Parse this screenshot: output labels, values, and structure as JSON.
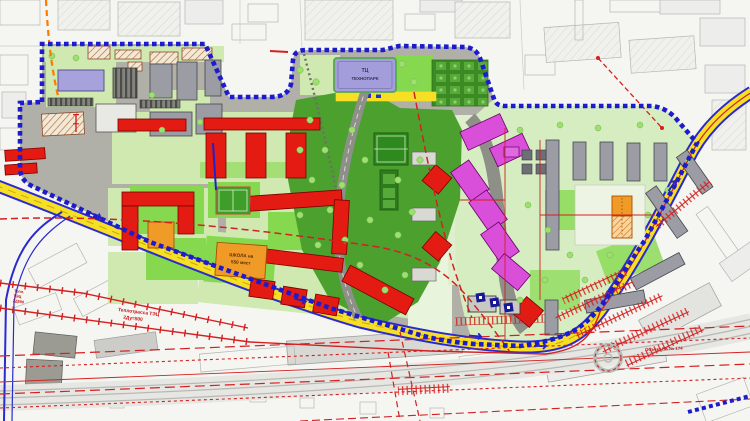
{
  "map": {
    "type": "urban-master-plan",
    "labels": {
      "mall": {
        "line1": "ТЦ",
        "line2": "ТЕХНОПАРК"
      },
      "school": {
        "line1": "ШКОЛА на",
        "line2": "550 мест"
      },
      "heat_main": {
        "line1": "Теплотрасса ТЭЦ",
        "line2": "2Ду=500"
      },
      "heat_main_left": {
        "line1": "Тепл.",
        "line2": "ТЭЦ",
        "line3": "2Д500"
      },
      "object_note": "Объект ПК № 174"
    },
    "legend_colors": {
      "boundary_blue": "#1c1ccd",
      "road_yellow": "#f6df25",
      "residential_new_red": "#e31b12",
      "residential_new_magenta": "#d94fd9",
      "public_orange": "#f09a28",
      "mall_violet": "#a49ddb",
      "park_green": "#4ba02e",
      "lawn_green": "#cfe9b0",
      "existing_gray": "#9b9ca4",
      "utility_red": "#d42020",
      "utility_orange": "#ff7a00"
    }
  }
}
